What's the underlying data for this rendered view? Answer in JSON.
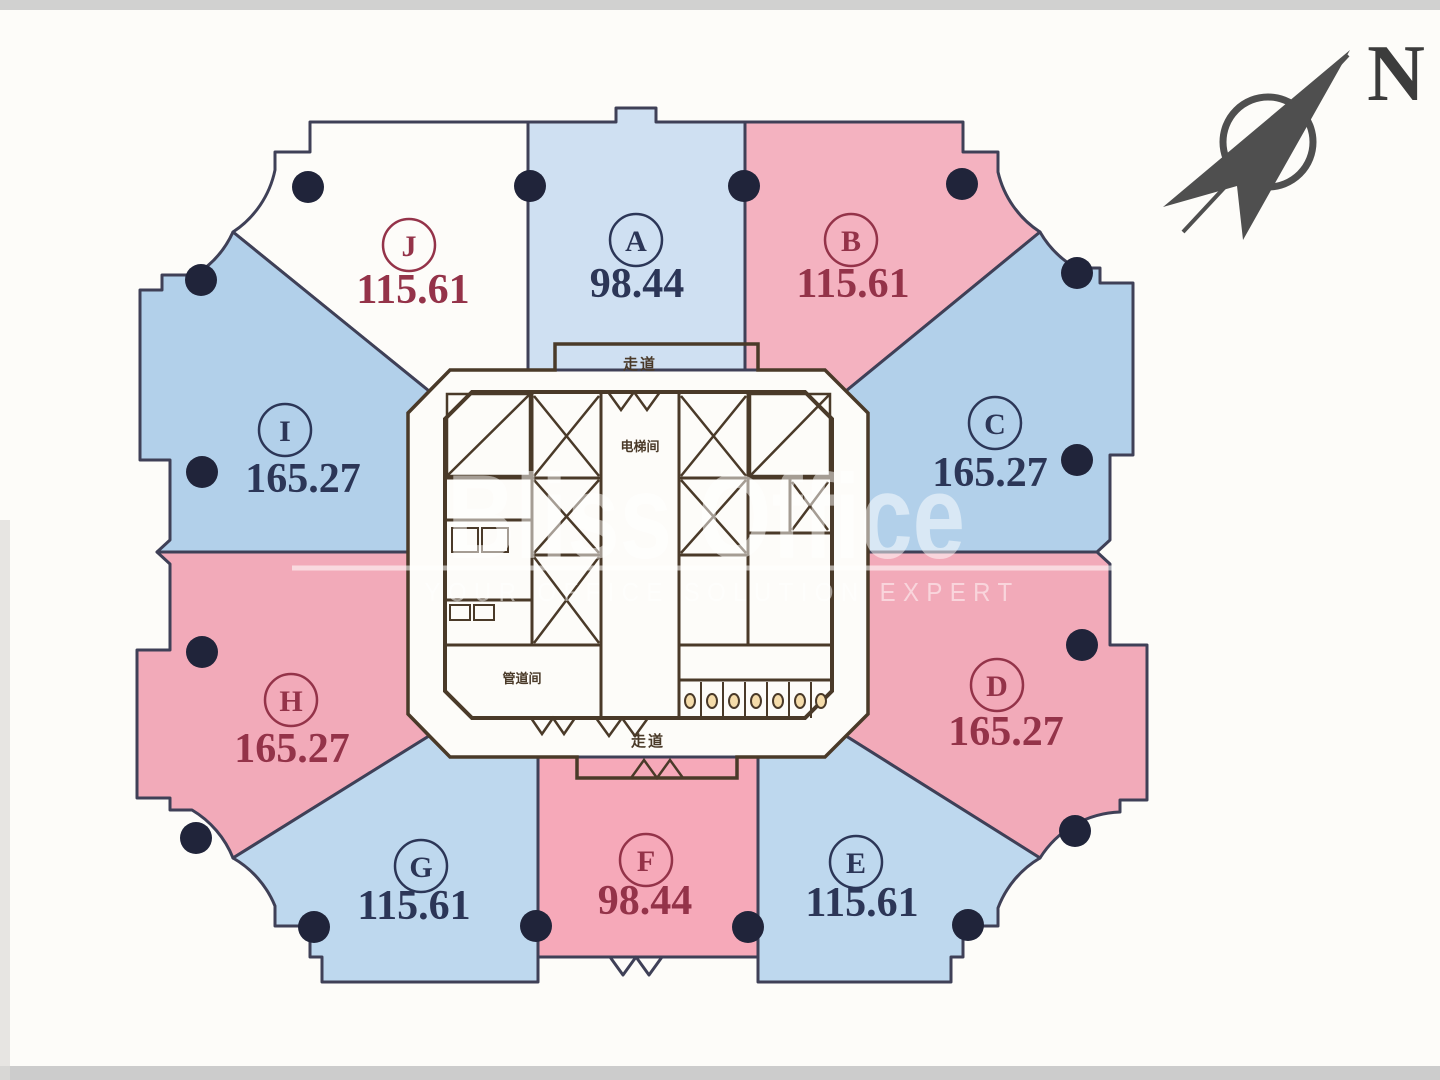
{
  "compass": {
    "label": "N"
  },
  "watermark": {
    "brand": "Bliss Office",
    "tagline": "YOUR OFFICE SOLUTION EXPERT"
  },
  "units": [
    {
      "id": "J",
      "area": "115.61",
      "fill": "#f4b2c0",
      "text": "#943349"
    },
    {
      "id": "A",
      "area": "98.44",
      "fill": "#cfe0f2",
      "text": "#2c3657"
    },
    {
      "id": "B",
      "area": "115.61",
      "fill": "#f4b2c0",
      "text": "#943349"
    },
    {
      "id": "I",
      "area": "165.27",
      "fill": "#b2d0ea",
      "text": "#2c3657"
    },
    {
      "id": "C",
      "area": "165.27",
      "fill": "#b2d0ea",
      "text": "#2c3657"
    },
    {
      "id": "H",
      "area": "165.27",
      "fill": "#f2aab9",
      "text": "#943349"
    },
    {
      "id": "D",
      "area": "165.27",
      "fill": "#f2aab9",
      "text": "#943349"
    },
    {
      "id": "G",
      "area": "115.61",
      "fill": "#bed8ee",
      "text": "#2c3657"
    },
    {
      "id": "F",
      "area": "98.44",
      "fill": "#f6a9b9",
      "text": "#943349"
    },
    {
      "id": "E",
      "area": "115.61",
      "fill": "#bed8ee",
      "text": "#2c3657"
    }
  ],
  "core_labels": {
    "corridor_top": "走道",
    "elevator_hall": "电梯间",
    "duct_room": "管道间",
    "corridor_bottom": "走道"
  },
  "colors": {
    "core": "#f5dcaa",
    "wall": "#4a3a29",
    "outline": "#3f4057",
    "column": "#20243a",
    "watermark": "#ffffff"
  }
}
